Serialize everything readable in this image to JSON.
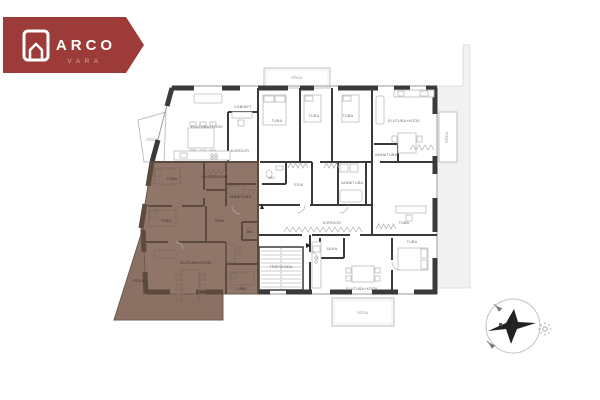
{
  "logo": {
    "brand": "ARCO",
    "sub": "VARA"
  },
  "colors": {
    "brand_red": "#9d3b38",
    "highlight_brown": "#8f7668",
    "highlight_wall": "#5c4a40",
    "wall_dark": "#3a3a3a",
    "terrace_gray": "#f1f1f1"
  },
  "plan": {
    "balconies": [
      {
        "label": "RÕDU"
      },
      {
        "label": "RÕDU"
      },
      {
        "label": "RÕDU"
      },
      {
        "label": "RÕDU"
      }
    ],
    "white_rooms": [
      {
        "label": "ELUTUBA+KÖÖK"
      },
      {
        "label": "KABINET"
      },
      {
        "label": "TUBA"
      },
      {
        "label": "TUBA"
      },
      {
        "label": "TUBA"
      },
      {
        "label": "ELUTUBA+KÖÖK"
      },
      {
        "label": "VANNITUBA"
      },
      {
        "label": "KORIDOR"
      },
      {
        "label": "WC"
      },
      {
        "label": "ESIK"
      },
      {
        "label": "VANNITUBA"
      },
      {
        "label": "KORIDOR"
      },
      {
        "label": "SAUN"
      },
      {
        "label": "TREPIKODA"
      },
      {
        "label": "ELUTUBA+KÖÖK"
      },
      {
        "label": "TUBA"
      },
      {
        "label": "TUBA"
      }
    ],
    "brown_rooms": [
      {
        "label": "TUBA"
      },
      {
        "label": "TUBA"
      },
      {
        "label": "GARDEROOB"
      },
      {
        "label": "VANNITUBA"
      },
      {
        "label": "ESIK"
      },
      {
        "label": "WC"
      },
      {
        "label": "ELUTUBA+KÖÖK"
      },
      {
        "label": "TUBA"
      },
      {
        "label": "RÕDU"
      }
    ]
  },
  "icons": {
    "logo": "house-icon",
    "compass": "compass-rose-icon",
    "sun": "sun-icon"
  }
}
